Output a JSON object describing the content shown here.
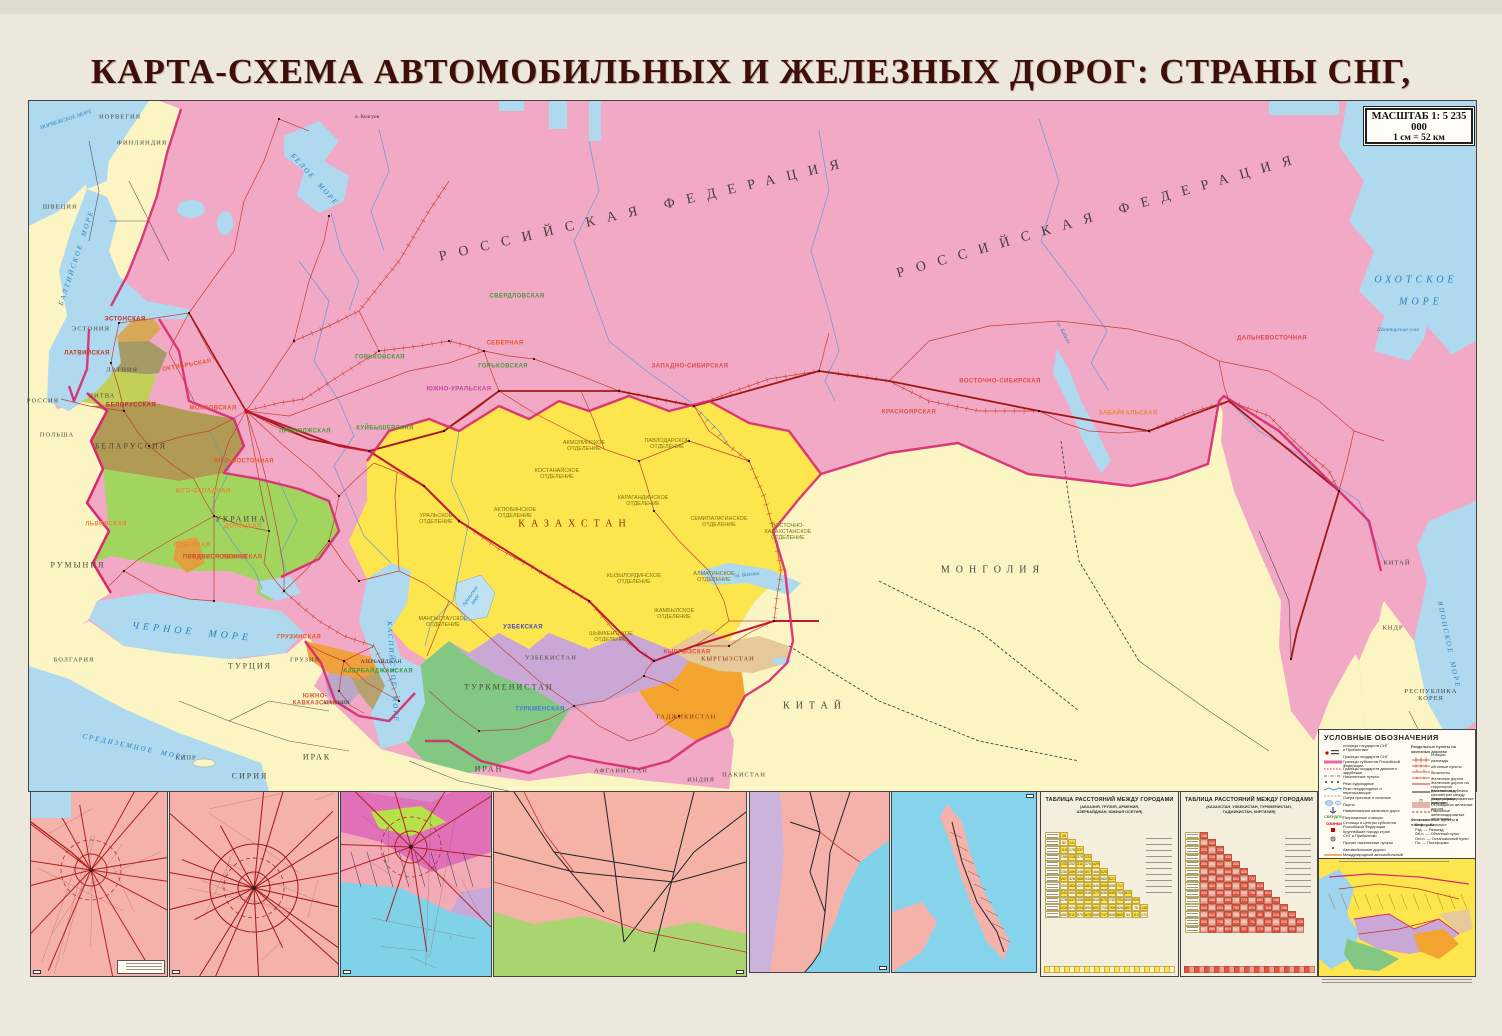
{
  "title": "КАРТА-СХЕМА АВТОМОБИЛЬНЫХ И ЖЕЛЕЗНЫХ ДОРОГ: СТРАНЫ СНГ, ПРИБАЛТИКИ",
  "scale_box": {
    "line1": "МАСШТАБ 1: 5 235 000",
    "line2": "1 см = 52 км"
  },
  "colors": {
    "russia_pink": "#f2a9c6",
    "foreign_yellow": "#fbf5c4",
    "kazakhstan_yellow": "#fde54d",
    "sea_blue": "#aed9ee",
    "cis_border": "#d8286e",
    "rail_red": "#c23a30",
    "title_maroon": "#3f0e08",
    "ukraine_green": "#a2d55e",
    "uzbek_lilac": "#c9a8d6",
    "turkmen_green": "#82c882",
    "tajik_orange": "#f2a42e"
  },
  "map": {
    "labels": [
      {
        "t": "НОРВЕГИЯ",
        "x": 120,
        "y": 117,
        "cls": "country-sm"
      },
      {
        "t": "ФИНЛЯНДИЯ",
        "x": 142,
        "y": 143,
        "cls": "country-sm"
      },
      {
        "t": "ШВЕЦИЯ",
        "x": 60,
        "y": 207,
        "cls": "country-sm"
      },
      {
        "t": "ЭСТОНИЯ",
        "x": 91,
        "y": 329,
        "cls": "country-sm"
      },
      {
        "t": "ЛАТВИЯ",
        "x": 122,
        "y": 370,
        "cls": "country-sm"
      },
      {
        "t": "ЛИТВА",
        "x": 102,
        "y": 396,
        "cls": "country-sm"
      },
      {
        "t": "РОССИЯ",
        "x": 43,
        "y": 401,
        "cls": "country-sm"
      },
      {
        "t": "ПОЛЬША",
        "x": 57,
        "y": 435,
        "cls": "country-sm"
      },
      {
        "t": "БЕЛАРУССИЯ",
        "x": 131,
        "y": 447,
        "cls": "country"
      },
      {
        "t": "УКРАИНА",
        "x": 241,
        "y": 520,
        "cls": "country"
      },
      {
        "t": "РУМЫНИЯ",
        "x": 78,
        "y": 566,
        "cls": "country"
      },
      {
        "t": "БОЛГАРИЯ",
        "x": 74,
        "y": 660,
        "cls": "country-sm"
      },
      {
        "t": "ТУРЦИЯ",
        "x": 250,
        "y": 667,
        "cls": "country"
      },
      {
        "t": "СИРИЯ",
        "x": 250,
        "y": 777,
        "cls": "country"
      },
      {
        "t": "ИРАК",
        "x": 317,
        "y": 758,
        "cls": "country"
      },
      {
        "t": "КИПР",
        "x": 186,
        "y": 758,
        "cls": "country-sm"
      },
      {
        "t": "ИРАН",
        "x": 489,
        "y": 770,
        "cls": "country"
      },
      {
        "t": "АФГАНИСТАН",
        "x": 621,
        "y": 771,
        "cls": "country-sm"
      },
      {
        "t": "ПАКИСТАН",
        "x": 744,
        "y": 775,
        "cls": "country-sm"
      },
      {
        "t": "ИНДИЯ",
        "x": 701,
        "y": 780,
        "cls": "country-sm"
      },
      {
        "t": "КИТАЙ",
        "x": 815,
        "y": 706,
        "cls": "country-big"
      },
      {
        "t": "МОНГОЛИЯ",
        "x": 993,
        "y": 570,
        "cls": "country-big"
      },
      {
        "t": "КИТАЙ",
        "x": 1397,
        "y": 563,
        "cls": "country-sm"
      },
      {
        "t": "КНДР",
        "x": 1393,
        "y": 628,
        "cls": "country-sm"
      },
      {
        "t": "РЕСПУБЛИКА\nКОРЕЯ",
        "x": 1431,
        "y": 695,
        "cls": "country-sm"
      },
      {
        "t": "КАЗАХСТАН",
        "x": 575,
        "y": 524,
        "cls": "country-big",
        "c": "#8b2e12"
      },
      {
        "t": "УЗБЕКИСТАН",
        "x": 551,
        "y": 658,
        "cls": "country-sm"
      },
      {
        "t": "ТУРКМЕНИСТАН",
        "x": 509,
        "y": 688,
        "cls": "country"
      },
      {
        "t": "ТАДЖИКИСТАН",
        "x": 686,
        "y": 717,
        "cls": "country-sm",
        "c": "#8b2e12"
      },
      {
        "t": "КЫРГЫЗСТАН",
        "x": 728,
        "y": 659,
        "cls": "country-sm",
        "c": "#8b2e12"
      },
      {
        "t": "ГРУЗИЯ",
        "x": 305,
        "y": 660,
        "cls": "country-sm"
      },
      {
        "t": "АЗЕРБАЙДЖАН",
        "x": 381,
        "y": 662,
        "cls": "tinyd"
      },
      {
        "t": "АРМЕНИЯ",
        "x": 336,
        "y": 703,
        "cls": "tinyd"
      },
      {
        "t": "РОССИЙСКАЯ ФЕДЕРАЦИЯ",
        "x": 645,
        "y": 210,
        "cls": "fed",
        "r": -13
      },
      {
        "t": "РОССИЙСКАЯ ФЕДЕРАЦИЯ",
        "x": 1100,
        "y": 216,
        "cls": "fed",
        "r": -16
      },
      {
        "t": "ОХОТСКОЕ",
        "x": 1416,
        "y": 280,
        "cls": "sea"
      },
      {
        "t": "МОРЕ",
        "x": 1421,
        "y": 302,
        "cls": "sea"
      },
      {
        "t": "ЯПОНСКОЕ  МОРЕ",
        "x": 1448,
        "y": 645,
        "cls": "sea-sm",
        "r": 78
      },
      {
        "t": "ЧЕРНОЕ  МОРЕ",
        "x": 192,
        "y": 632,
        "cls": "sea",
        "r": 6
      },
      {
        "t": "СРЕДИЗЕМНОЕ  МОРЕ",
        "x": 135,
        "y": 748,
        "cls": "sea-sm",
        "r": 12
      },
      {
        "t": "КАСПИЙСКОЕ  МОРЕ",
        "x": 392,
        "y": 672,
        "cls": "sea-sm",
        "r": 86
      },
      {
        "t": "БЕЛОЕ  МОРЕ",
        "x": 314,
        "y": 180,
        "cls": "sea-sm",
        "r": 48
      },
      {
        "t": "БАЛТИЙСКОЕ  МОРЕ",
        "x": 77,
        "y": 258,
        "cls": "sea-sm",
        "r": -72
      },
      {
        "t": "НОРВЕЖСКОЕ МОРЕ",
        "x": 66,
        "y": 120,
        "cls": "tinyb",
        "r": -18
      },
      {
        "t": "о. Колгуев",
        "x": 367,
        "y": 117,
        "cls": "tinyd"
      },
      {
        "t": "Шантарские о-ва",
        "x": 1398,
        "y": 330,
        "cls": "tinyb"
      },
      {
        "t": "оз. Байкал",
        "x": 1063,
        "y": 333,
        "cls": "tinyb",
        "r": 62
      },
      {
        "t": "Аральское\nморе",
        "x": 473,
        "y": 598,
        "cls": "tinyb",
        "r": -55
      },
      {
        "t": "оз. Балхаш",
        "x": 747,
        "y": 575,
        "cls": "tinyb",
        "r": -6
      },
      {
        "t": "ОКТЯБРЬСКАЯ",
        "x": 187,
        "y": 366,
        "cls": "rail",
        "c": "#e05a28",
        "r": -10
      },
      {
        "t": "МОСКОВСКАЯ",
        "x": 213,
        "y": 409,
        "cls": "rail",
        "c": "#e05a28"
      },
      {
        "t": "СЕВЕРНАЯ",
        "x": 505,
        "y": 344,
        "cls": "rail",
        "c": "#e05a28"
      },
      {
        "t": "ГОРЬКОВСКАЯ",
        "x": 380,
        "y": 358,
        "cls": "rail",
        "c": "#4a9a3a"
      },
      {
        "t": "ГОРЬКОВСКАЯ",
        "x": 503,
        "y": 367,
        "cls": "rail",
        "c": "#4a9a3a"
      },
      {
        "t": "СВЕРДЛОВСКАЯ",
        "x": 517,
        "y": 297,
        "cls": "rail",
        "c": "#4a9a3a"
      },
      {
        "t": "КУЙБЫШЕВСКАЯ",
        "x": 385,
        "y": 429,
        "cls": "rail",
        "c": "#4a9a3a"
      },
      {
        "t": "ЮЖНО-УРАЛЬСКАЯ",
        "x": 459,
        "y": 390,
        "cls": "rail",
        "c": "#c545a0"
      },
      {
        "t": "ЗАПАДНО-СИБИРСКАЯ",
        "x": 690,
        "y": 367,
        "cls": "rail",
        "c": "#e04848"
      },
      {
        "t": "КРАСНОЯРСКАЯ",
        "x": 909,
        "y": 413,
        "cls": "rail",
        "c": "#d2543a"
      },
      {
        "t": "ВОСТОЧНО-СИБИРСКАЯ",
        "x": 1000,
        "y": 382,
        "cls": "rail",
        "c": "#e04848"
      },
      {
        "t": "ЗАБАЙКАЛЬСКАЯ",
        "x": 1128,
        "y": 414,
        "cls": "rail",
        "c": "#e8853a"
      },
      {
        "t": "ДАЛЬНЕВОСТОЧНАЯ",
        "x": 1272,
        "y": 339,
        "cls": "rail",
        "c": "#e04848"
      },
      {
        "t": "ЮГО-ВОСТОЧНАЯ",
        "x": 244,
        "y": 462,
        "cls": "rail",
        "c": "#e05a28"
      },
      {
        "t": "ПРИВОЛЖСКАЯ",
        "x": 305,
        "y": 432,
        "cls": "rail",
        "c": "#4a9a3a"
      },
      {
        "t": "СЕВЕРО-КАВКАЗСКАЯ",
        "x": 225,
        "y": 558,
        "cls": "rail",
        "c": "#e05a28"
      },
      {
        "t": "ЮГО-ЗАПАДНАЯ",
        "x": 203,
        "y": 492,
        "cls": "rail",
        "c": "#e8853a"
      },
      {
        "t": "ОДЕССКАЯ",
        "x": 192,
        "y": 546,
        "cls": "rail",
        "c": "#e8853a"
      },
      {
        "t": "ПРИДНЕПРОВСКАЯ",
        "x": 215,
        "y": 558,
        "cls": "rail",
        "c": "#d2543a"
      },
      {
        "t": "ДОНЕЦКАЯ",
        "x": 243,
        "y": 527,
        "cls": "rail",
        "c": "#e8853a"
      },
      {
        "t": "ЛЬВОВСКАЯ",
        "x": 106,
        "y": 525,
        "cls": "rail",
        "c": "#e8853a"
      },
      {
        "t": "БЕЛОРУССКАЯ",
        "x": 131,
        "y": 406,
        "cls": "rail",
        "c": "#c03028"
      },
      {
        "t": "ЛАТВИЙСКАЯ",
        "x": 87,
        "y": 354,
        "cls": "rail",
        "c": "#c03028"
      },
      {
        "t": "ЭСТОНСКАЯ",
        "x": 125,
        "y": 320,
        "cls": "rail",
        "c": "#c03028"
      },
      {
        "t": "ГРУЗИНСКАЯ",
        "x": 299,
        "y": 638,
        "cls": "rail",
        "c": "#e05a28"
      },
      {
        "t": "АЗЕРБАЙДЖАНСКАЯ",
        "x": 378,
        "y": 672,
        "cls": "rail",
        "c": "#3a9a40"
      },
      {
        "t": "ЮЖНО-\nКАВКАЗСКАЯ",
        "x": 315,
        "y": 700,
        "cls": "rail",
        "c": "#d2543a"
      },
      {
        "t": "УЗБЕКСКАЯ",
        "x": 523,
        "y": 628,
        "cls": "rail",
        "c": "#4848c8"
      },
      {
        "t": "ТУРКМЕНСКАЯ",
        "x": 540,
        "y": 710,
        "cls": "rail",
        "c": "#4878d8"
      },
      {
        "t": "КЫРГЫЗСКАЯ",
        "x": 687,
        "y": 653,
        "cls": "rail",
        "c": "#e04848"
      },
      {
        "t": "УРАЛЬСКОЕ\nОТДЕЛЕНИЕ",
        "x": 436,
        "y": 519,
        "cls": "div"
      },
      {
        "t": "АКТЮБИНСКОЕ\nОТДЕЛЕНИЕ",
        "x": 515,
        "y": 513,
        "cls": "div"
      },
      {
        "t": "КОСТАНАЙСКОЕ\nОТДЕЛЕНИЕ",
        "x": 557,
        "y": 474,
        "cls": "div"
      },
      {
        "t": "АКМОЛИНСКОЕ\nОТДЕЛЕНИЕ",
        "x": 584,
        "y": 446,
        "cls": "div"
      },
      {
        "t": "ПАВЛОДАРСКОЕ\nОТДЕЛЕНИЕ",
        "x": 667,
        "y": 444,
        "cls": "div"
      },
      {
        "t": "КАРАГАНДИНСКОЕ\nОТДЕЛЕНИЕ",
        "x": 643,
        "y": 501,
        "cls": "div"
      },
      {
        "t": "СЕМИПАЛАТИНСКОЕ\nОТДЕЛЕНИЕ",
        "x": 719,
        "y": 522,
        "cls": "div"
      },
      {
        "t": "КЫЗЫЛОРДИНСКОЕ\nОТДЕЛЕНИЕ",
        "x": 634,
        "y": 579,
        "cls": "div"
      },
      {
        "t": "АЛМАТИНСКОЕ\nОТДЕЛЕНИЕ",
        "x": 714,
        "y": 577,
        "cls": "div"
      },
      {
        "t": "ЖАМБЫЛСКОЕ\nОТДЕЛЕНИЕ",
        "x": 674,
        "y": 614,
        "cls": "div"
      },
      {
        "t": "ШЫМКЕНТСКОЕ\nОТДЕЛЕНИЕ",
        "x": 611,
        "y": 637,
        "cls": "div"
      },
      {
        "t": "МАНГЫСТАУСКОЕ\nОТДЕЛЕНИЕ",
        "x": 443,
        "y": 622,
        "cls": "div"
      },
      {
        "t": "ВОСТОЧНО-\nКАЗАХСТАНСКОЕ\nОТДЕЛЕНИЕ",
        "x": 788,
        "y": 532,
        "cls": "div"
      }
    ]
  },
  "insets": [
    {
      "label": "САНКТ-ПЕТЕРБУРГ"
    },
    {
      "label": "МОСКВА"
    },
    {
      "label": "КРАСНОДАР, ВОЛГОГРАД"
    },
    {
      "label": "ЕКАТЕРИНБУРГ, ЧЕЛЯБИНСК",
      "interior": "К А З А Х С Т А Н"
    },
    {
      "label": "ВЛАДИВОСТОК",
      "rail": "ДАЛЬНЕВОСТОЧНАЯ",
      "region": "ПРИМОРСКИЙ\nКРАЙ",
      "country_left": "К И Т А Й",
      "sea": "ЯПОНСКОЕ\nМОРЕ",
      "country_sw": "КНДР"
    },
    {
      "label": "О. САХАЛИН"
    }
  ],
  "tables": [
    {
      "title": "ТАБЛИЦА РАССТОЯНИЙ МЕЖДУ ГОРОДАМИ",
      "subtitle": "(АБХАЗИЯ, ГРУЗИЯ, АРМЕНИЯ,\nАЗЕРБАЙДЖАН, ЮЖНАЯ ОСЕТИЯ)",
      "rows": 12,
      "theme": "yellow"
    },
    {
      "title": "ТАБЛИЦА РАССТОЯНИЙ МЕЖДУ ГОРОДАМИ",
      "subtitle": "(КАЗАХСТАН, УЗБЕКИСТАН, ТУРКМЕНИСТАН,\nТАДЖИКИСТАН, КИРГИЗИЯ)",
      "rows": 14,
      "theme": "red"
    }
  ],
  "legend": {
    "header": "УСЛОВНЫЕ ОБОЗНАЧЕНИЯ",
    "left": [
      {
        "g": "capitals",
        "t": "столицы государств СНГ\nи Прибалтики"
      },
      {
        "g": "border-cis",
        "t": "Границы государств СНГ"
      },
      {
        "g": "border-subj",
        "t": "Границы субъектов Российской Федерации"
      },
      {
        "g": "border-far",
        "t": "Границы государств дальнего зарубежья"
      },
      {
        "g": "pop",
        "t": "Населенные пункты"
      },
      {
        "g": "river-nav",
        "t": "Реки судоходные"
      },
      {
        "g": "river-dry",
        "t": "Реки несудоходные и пересыхающие"
      },
      {
        "g": "lakes",
        "t": "Озера пресные и соленые"
      },
      {
        "g": "ports",
        "t": "Порты"
      },
      {
        "g": "rail-name",
        "t": "Наименования железных дорог"
      },
      {
        "g": "border-sample",
        "t": "Пограничные станции"
      },
      {
        "g": "capitals-rf",
        "t": "Столицы и центры субъектов\nРоссийской Федерации"
      },
      {
        "g": "big-cities",
        "t": "Крупнейшие города стран\nСНГ и Прибалтики"
      },
      {
        "g": "other-cities",
        "t": "Прочие населенные пункты"
      },
      {
        "g": "roads",
        "t": "Автомобильные дороги"
      },
      {
        "g": "corridor",
        "t": "Международный автомобильный коридор\n«Западная Европа — Западный Китай»"
      }
    ],
    "right_header": "Раздельные пункты на железных дорогах",
    "right": [
      {
        "g": "st",
        "t": "станции"
      },
      {
        "g": "rzd",
        "t": "разъезды"
      },
      {
        "g": "obp",
        "t": "обгонные пункты"
      },
      {
        "g": "blp",
        "t": "блокпосты"
      },
      {
        "g": "zhd",
        "t": "Железные дороги"
      },
      {
        "g": "zhd-far",
        "t": "Железные дороги на территории\nдальнего зарубежья"
      },
      {
        "g": "dist",
        "t": "Расстояния в километрах между\nраздельными пунктами"
      },
      {
        "g": "el",
        "t": "Электрифицированные участки"
      },
      {
        "g": "build",
        "t": "Строящиеся железные дороги"
      },
      {
        "g": "ferry",
        "t": "Паромные железнодорожные переправы"
      }
    ],
    "stops_header": "Остановочные пункты и платформы",
    "stops": [
      "Бл.п. — Блокпост",
      "Рзд. — Разъезд",
      "Об.п. — Обгонный пункт",
      "Ост.п. — Остановочный пункт",
      "Пл. — Платформа"
    ],
    "rail_name_sample": "СВЕРДЛОВСКАЯ",
    "border_sample": "ОЗИНКИ"
  }
}
